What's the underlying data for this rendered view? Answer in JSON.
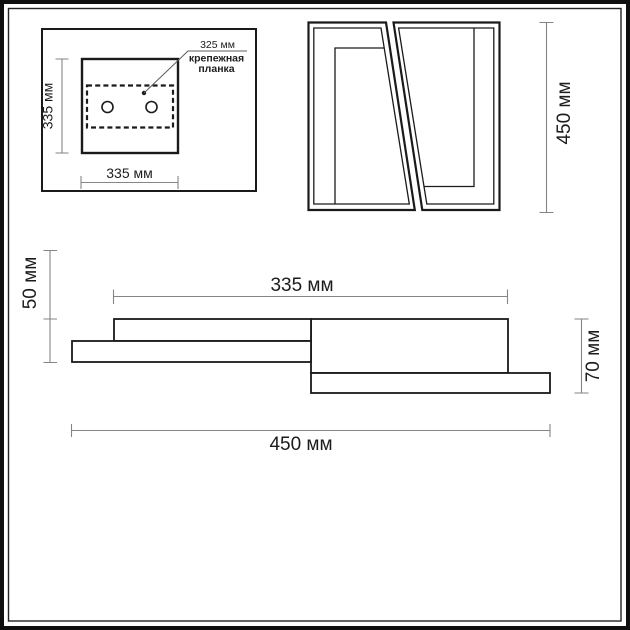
{
  "drawing": {
    "units": "мм",
    "colors": {
      "outline": "#1a1a1a",
      "dimension_line": "#858585",
      "background": "#ffffff"
    },
    "top_view": {
      "side_dim_label": "335 мм",
      "bottom_dim_label": "335 мм",
      "plate_width_label": "325 мм",
      "plate_name_line1": "крепежная",
      "plate_name_line2": "планка",
      "mounting_holes_count": 2
    },
    "front_view": {
      "height_dim_label": "450 мм"
    },
    "side_view": {
      "left_height_dim_label": "50 мм",
      "top_width_dim_label": "335 мм",
      "right_height_dim_label": "70 мм",
      "total_width_dim_label": "450 мм"
    }
  }
}
